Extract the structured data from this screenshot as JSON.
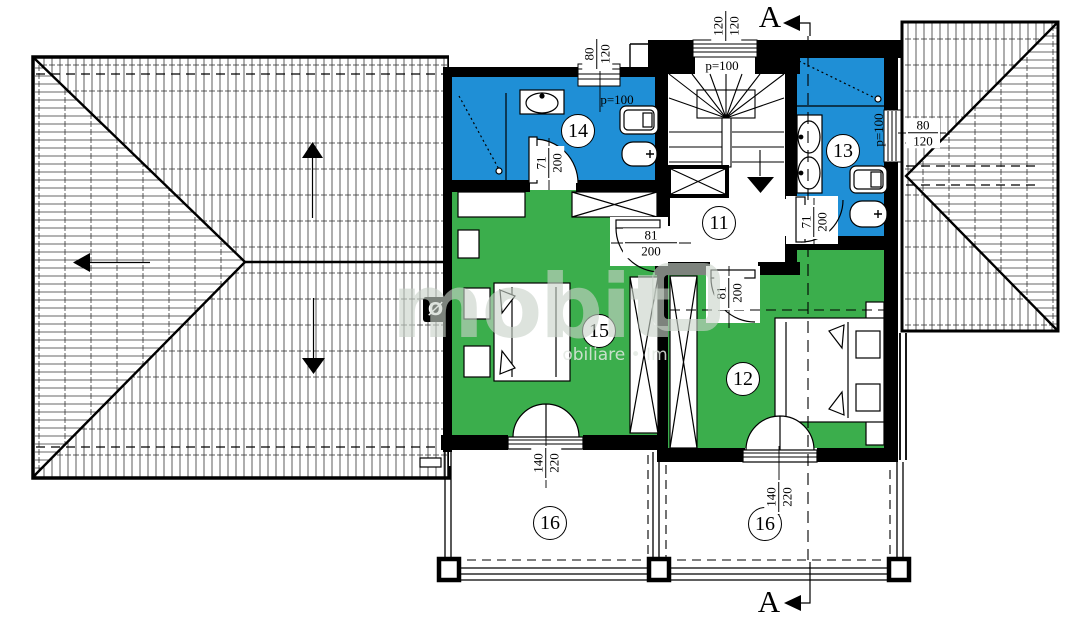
{
  "colors": {
    "bathroom": "#1f8fd6",
    "bedroom": "#3bae4c",
    "wall": "#000000"
  },
  "watermark": {
    "brand": "mobit",
    "subtitle": "obiliare • Im"
  },
  "section": {
    "top_label": "A",
    "bottom_label": "A"
  },
  "drain_symbol": "Ø",
  "rooms": [
    {
      "number": "11"
    },
    {
      "number": "12"
    },
    {
      "number": "13"
    },
    {
      "number": "14"
    },
    {
      "number": "15"
    },
    {
      "number": "16"
    },
    {
      "number": "16"
    }
  ],
  "parapet_labels": [
    {
      "text": "p=100"
    },
    {
      "text": "p=100"
    },
    {
      "text": "p=100"
    }
  ],
  "dimensions": [
    {
      "w": "80",
      "h": "120"
    },
    {
      "w": "120",
      "h": "120"
    },
    {
      "w": "80",
      "h": "120"
    },
    {
      "w": "71",
      "h": "200"
    },
    {
      "w": "71",
      "h": "200"
    },
    {
      "w": "81",
      "h": "200"
    },
    {
      "w": "81",
      "h": "200"
    },
    {
      "w": "140",
      "h": "220"
    },
    {
      "w": "140",
      "h": "220"
    }
  ]
}
